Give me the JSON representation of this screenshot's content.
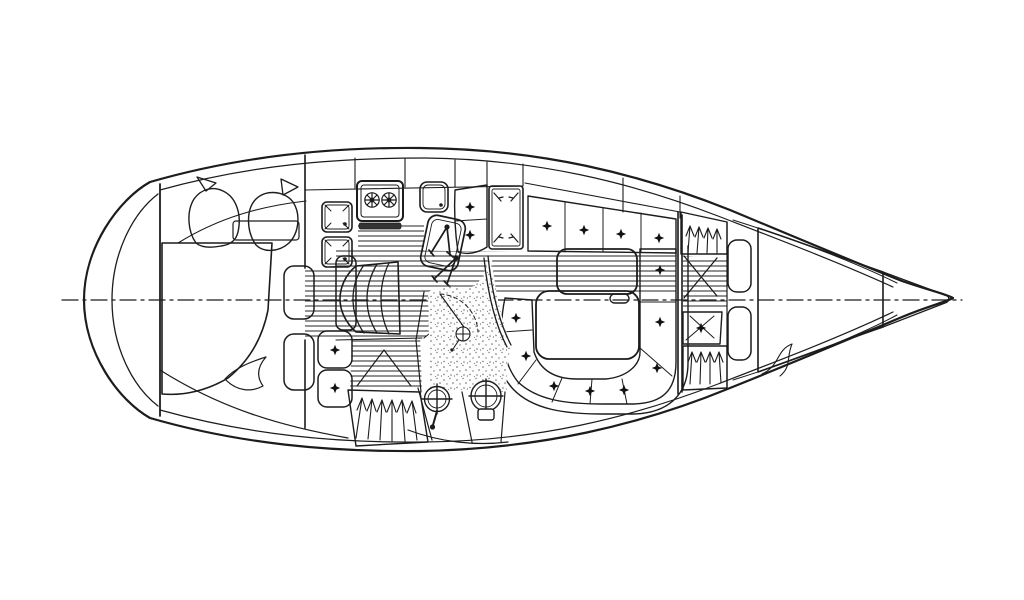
{
  "meta": {
    "title": "Sailboat interior floor plan — top view line drawing",
    "drawing_type": "yacht accommodation layout, bow to the right, no text labels"
  },
  "colors": {
    "background": "#ffffff",
    "line": "#1c1c1c",
    "cushion_gray": "#a9a9a9",
    "stove_front": "#333333"
  },
  "regions": {
    "hull": {
      "parts": [
        "outer-hull",
        "inner-sheer-line",
        "transom-curves",
        "transom-bulkhead",
        "bow-tip",
        "centerline-dash-dot"
      ]
    },
    "aft_cabin": {
      "parts": [
        "double-berth-mattress-crosshatch",
        "pillow-left",
        "pillow-right",
        "headboard-shelf",
        "bedding-flap",
        "side-shelf-upper",
        "side-shelf-lower",
        "bulkhead-with-doorway"
      ]
    },
    "galley": {
      "parts": [
        "twin-sink-left",
        "twin-sink-right",
        "two-burner-stove",
        "oven-front",
        "single-sink",
        "counter-edge",
        "striped-sole"
      ]
    },
    "nav_station": {
      "parts": [
        "chart-table",
        "dividers-tool-upper",
        "dividers-tool-lower",
        "navigator-seat-cushions",
        "locker-hatch-with-corner-marks"
      ]
    },
    "companionway": {
      "parts": [
        "step-platform",
        "curved-ladder-steps"
      ]
    },
    "salon": {
      "starboard_settee_cushions": 4,
      "u_settee_cushions": 8,
      "parts": [
        "saloon-table-upper-leaf",
        "saloon-table-lower-leaf",
        "table-latch-handle",
        "settee-backrest-line",
        "striped-seat-band"
      ]
    },
    "head": {
      "parts": [
        "speckled-shower-floor",
        "door-swing-arc",
        "shower-drain-fitting",
        "washbasin-with-faucet",
        "marine-toilet",
        "curved-partition"
      ]
    },
    "hanging_lockers": {
      "count": 3,
      "parts": [
        "locker-bottom-center",
        "locker-forward-port",
        "locker-forward-starboard"
      ],
      "symbol": "clothes-hanger-strokes"
    },
    "forward_cabin": {
      "parts": [
        "v-berth-mattress-crosshatch",
        "entry-door-swing-cross",
        "seat-cushion",
        "shelf-upper",
        "shelf-lower",
        "bulkhead",
        "liner-curve"
      ]
    }
  }
}
